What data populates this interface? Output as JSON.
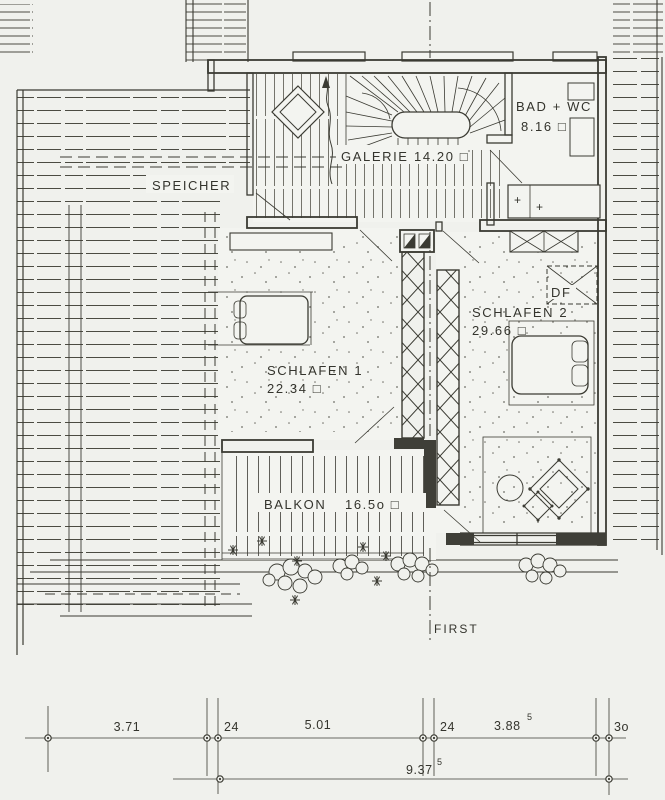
{
  "rooms": {
    "speicher": {
      "name": "SPEICHER"
    },
    "galerie": {
      "name": "GALERIE",
      "area": "14.20 □"
    },
    "bad_wc": {
      "name": "BAD + WC",
      "area": "8.16 □"
    },
    "schlafen1": {
      "name": "SCHLAFEN 1",
      "area": "22.34 □"
    },
    "schlafen2": {
      "name": "SCHLAFEN 2",
      "area": "29.66 □"
    },
    "balkon": {
      "name": "BALKON",
      "area": "16.5o □"
    }
  },
  "annotations": {
    "roof_window": "DF",
    "ridge": "FIRST",
    "fixture_marks": [
      "+",
      "+"
    ]
  },
  "dimensions": {
    "top_chain": [
      "3.71",
      "24",
      "5.01",
      "24",
      "3.88",
      "3o"
    ],
    "chain_sup": "5",
    "total": "9.37",
    "total_sup": "5"
  },
  "colors": {
    "paper": "#f0f1ed",
    "ink": "#3b3b33"
  }
}
